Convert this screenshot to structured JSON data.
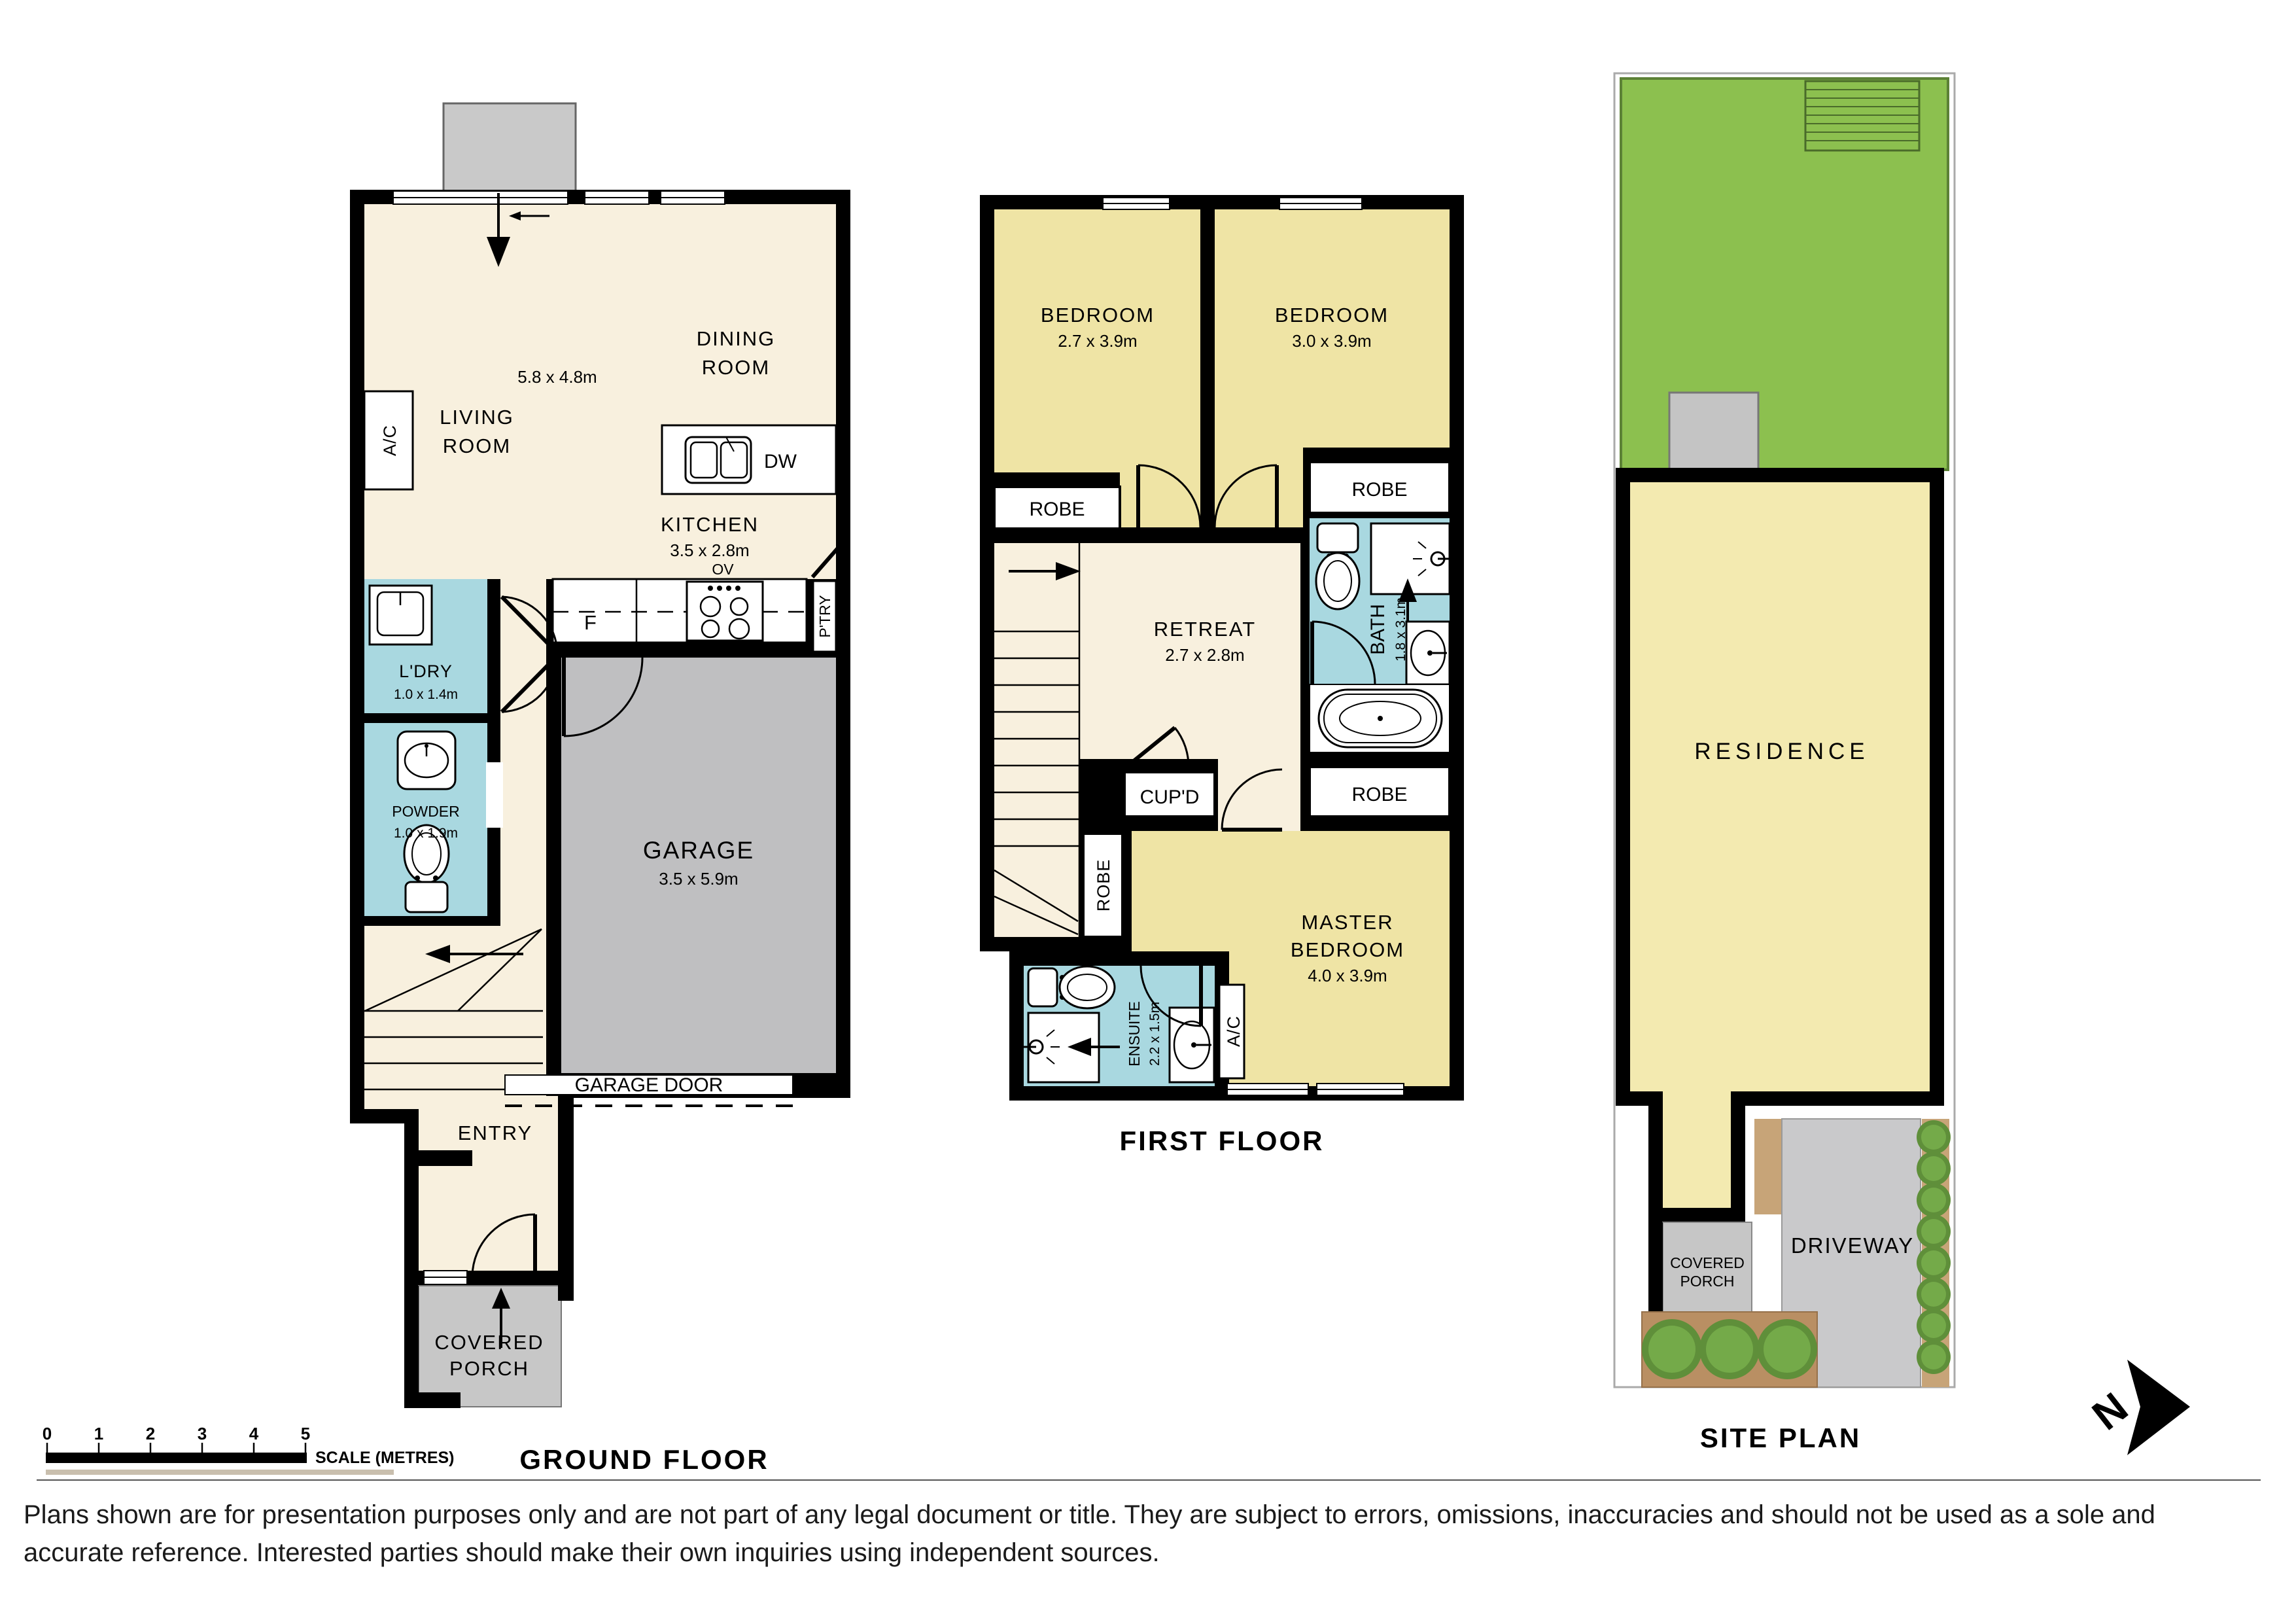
{
  "titles": {
    "ground": "GROUND FLOOR",
    "first": "FIRST FLOOR",
    "site": "SITE PLAN"
  },
  "ground": {
    "living": {
      "l1": "LIVING",
      "l2": "ROOM"
    },
    "open_dims": "5.8 x 4.8m",
    "dining": {
      "l1": "DINING",
      "l2": "ROOM"
    },
    "kitchen": {
      "label": "KITCHEN",
      "dims": "3.5 x 2.8m"
    },
    "labels": {
      "dw": "DW",
      "fridge": "F",
      "oven": "OV",
      "pantry": "P'TRY",
      "ac": "A/C"
    },
    "laundry": {
      "label": "L'DRY",
      "dims": "1.0 x 1.4m"
    },
    "powder": {
      "label": "POWDER",
      "dims": "1.0 x 1.9m"
    },
    "garage": {
      "label": "GARAGE",
      "dims": "3.5 x 5.9m",
      "door": "GARAGE DOOR"
    },
    "entry": {
      "label": "ENTRY"
    },
    "porch": {
      "l1": "COVERED",
      "l2": "PORCH"
    }
  },
  "first": {
    "bedroom1": {
      "label": "BEDROOM",
      "dims": "2.7 x 3.9m"
    },
    "bedroom2": {
      "label": "BEDROOM",
      "dims": "3.0 x 3.9m"
    },
    "retreat": {
      "label": "RETREAT",
      "dims": "2.7 x 2.8m"
    },
    "bath": {
      "label": "BATH",
      "dims": "1.8 x 3.1m"
    },
    "master": {
      "l1": "MASTER",
      "l2": "BEDROOM",
      "dims": "4.0 x 3.9m"
    },
    "ensuite": {
      "label": "ENSUITE",
      "dims": "2.2 x 1.5m"
    },
    "cupd": "CUP'D",
    "ac": "A/C",
    "robe_left": "ROBE",
    "robe_right": "ROBE",
    "robe_master_right": "ROBE",
    "robe_master_left": "ROBE"
  },
  "site": {
    "residence": "RESIDENCE",
    "driveway": "DRIVEWAY",
    "porch": {
      "l1": "COVERED",
      "l2": "PORCH"
    }
  },
  "scalebar": {
    "ticks": [
      "0",
      "1",
      "2",
      "3",
      "4",
      "5"
    ],
    "label": "SCALE (METRES)"
  },
  "north": {
    "letter": "N"
  },
  "disclaimer": {
    "line1": "Plans shown are for presentation purposes only and are not part of any legal document or title. They are subject to errors, omissions, inaccuracies and should not be used as a sole and",
    "line2": "accurate reference. Interested parties should make their own inquiries using independent sources."
  },
  "colors": {
    "wall": "#000000",
    "floor_cream": "#f8f0de",
    "bedroom_yellow": "#efe4a5",
    "wet_area_blue": "#a9d8e0",
    "garage_gray": "#bfbfc1",
    "porch_gray": "#c7c7c7",
    "grass_green": "#8cc04f",
    "residence_yellow": "#f3eab0",
    "driveway_gray": "#c9c9cb",
    "garden_tan": "#c7a478",
    "bush_green": "#6da348"
  }
}
